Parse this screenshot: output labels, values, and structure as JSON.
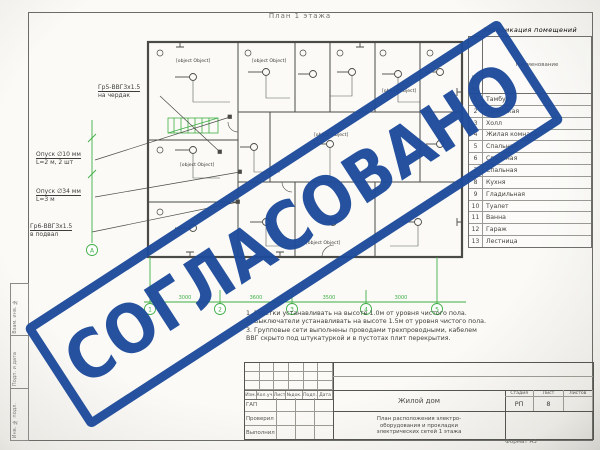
{
  "colors": {
    "stamp_blue": "#1d4b9b",
    "drawing_green": "#3fae46",
    "line_gray": "#4a4a46"
  },
  "stamp": {
    "text": "СОГЛАСОВАНО"
  },
  "sheet": {
    "plan_title": "План 1 этажа",
    "format_label": "Формат А3"
  },
  "side_strip": {
    "labels": [
      "Взам. инв. №",
      "Подп. и дата",
      "Инв. № подл."
    ]
  },
  "callouts": [
    {
      "line1": "Гр5-ВВГ3х1.5",
      "line2": "на чердак"
    },
    {
      "line1": "Опуск ∅10 мм",
      "line2": "L=2 м, 2 шт"
    },
    {
      "line1": "Опуск ∅34 мм",
      "line2": "L=3 м"
    },
    {
      "line1": "Гр6-ВВГ3х1.5",
      "line2": "в подвал"
    }
  ],
  "plan": {
    "axes_bottom": [
      "1",
      "2",
      "3",
      "4",
      "5"
    ],
    "axis_left": "А",
    "dims": [
      "3000",
      "3600",
      "3500",
      "3000"
    ],
    "labels": [
      {
        "t": "ВВГ 3х1.5"
      },
      {
        "t": "НВ-1Б"
      },
      {
        "t": "ПВ 1х2"
      },
      {
        "t": "Гр.2"
      },
      {
        "t": "8а"
      },
      {
        "t": "ЩК"
      }
    ]
  },
  "explication": {
    "title": "Экспликация помещений",
    "col_num": "№ п/п",
    "col_name": "Наименование",
    "rows": [
      {
        "n": "1",
        "name": "Тамбур"
      },
      {
        "n": "2",
        "name": "Прихожая"
      },
      {
        "n": "3",
        "name": "Холл"
      },
      {
        "n": "4",
        "name": "Жилая комната"
      },
      {
        "n": "5",
        "name": "Спальная"
      },
      {
        "n": "6",
        "name": "Спальная"
      },
      {
        "n": "7",
        "name": "Спальная"
      },
      {
        "n": "8",
        "name": "Кухня"
      },
      {
        "n": "9",
        "name": "Гладильная"
      },
      {
        "n": "10",
        "name": "Туалет"
      },
      {
        "n": "11",
        "name": "Ванна"
      },
      {
        "n": "12",
        "name": "Гараж"
      },
      {
        "n": "13",
        "name": "Лестница"
      }
    ]
  },
  "notes": {
    "lines": [
      "1. Розетки устанавливать на высоте 1.0м от уровня чистого пола.",
      "2. Выключатели устанавливать на высоте 1.5м от уровня чистого пола.",
      "3. Групповые сети выполнены проводами трехпроводными, кабелем",
      "    ВВГ скрыто под штукатуркой и в пустотах плит перекрытия."
    ]
  },
  "titleblock": {
    "rev_headers": [
      "Изм.",
      "Кол.уч.",
      "Лист",
      "№док.",
      "Подп.",
      "Дата"
    ],
    "roles": [
      "ГАП",
      "Проверил",
      "Выполнил"
    ],
    "object_name": "Жилой дом",
    "doc_lines": [
      "План расположения электро-",
      "оборудования и прокладки",
      "электрических сетей 1 этажа"
    ],
    "stage_header": "Стадия",
    "sheet_header": "Лист",
    "sheets_header": "Листов",
    "stage": "РП",
    "sheet_no": "8",
    "sheets_total": ""
  }
}
